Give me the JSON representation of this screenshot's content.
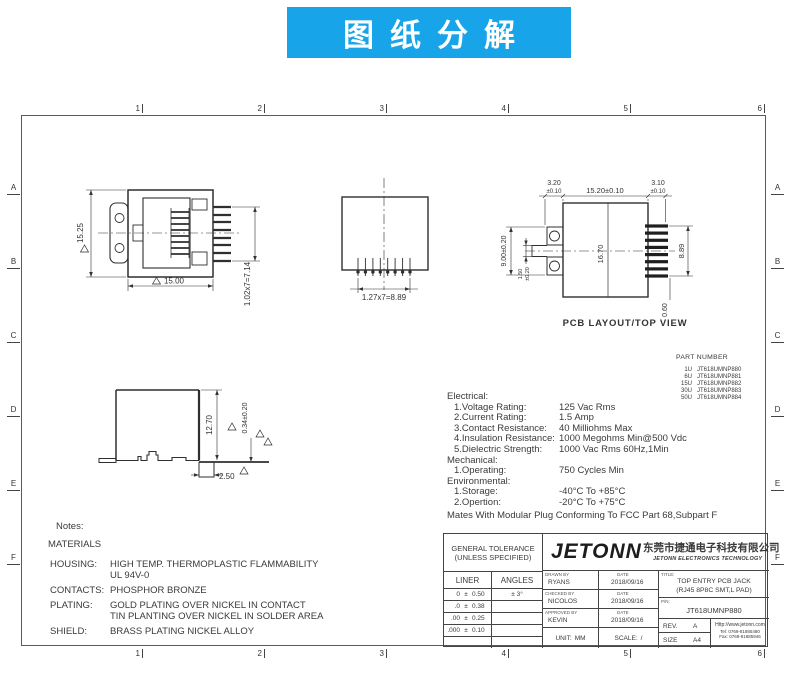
{
  "banner": {
    "title": "图纸分解",
    "bg_color": "#18a4e8"
  },
  "sheet": {
    "zone_cols": [
      "1",
      "2",
      "3",
      "4",
      "5",
      "6"
    ],
    "zone_rows": [
      "A",
      "B",
      "C",
      "D",
      "E",
      "F"
    ]
  },
  "views": {
    "front": {
      "dim_height": "15.25",
      "dim_width": "15.00",
      "dim_pin_span": "1.02x7=7.14"
    },
    "bottom": {
      "dim_pin_span": "1.27x7=8.89"
    },
    "pcb": {
      "caption": "PCB LAYOUT/TOP VIEW",
      "dim_tab": "3.20",
      "dim_tab_tol": "±0.10",
      "dim_body": "15.20±0.10",
      "dim_pin": "3.10",
      "dim_pin_tol": "±0.10",
      "dim_tab_pitch": "9.00±0.20",
      "dim_slot": "1.50",
      "dim_slot_tol": "±0.20",
      "dim_body_h": "16.70",
      "dim_pin_span": "8.89",
      "dim_pin_w": "0.60"
    },
    "side": {
      "dim_height": "12.70",
      "dim_pad": "0.34±0.20",
      "dim_foot": "2.50"
    }
  },
  "part_number": {
    "title": "PART NUMBER",
    "rows": [
      {
        "u": "1U",
        "pn": "JT618UMNP880"
      },
      {
        "u": "6U",
        "pn": "JT618UMNP881"
      },
      {
        "u": "15U",
        "pn": "JT618UMNP882"
      },
      {
        "u": "30U",
        "pn": "JT618UMNP883"
      },
      {
        "u": "50U",
        "pn": "JT618UMNP884"
      }
    ]
  },
  "specs": {
    "sections": [
      {
        "heading": "Electrical:",
        "items": [
          [
            "1.Voltage Rating:",
            "125 Vac Rms"
          ],
          [
            "2.Current Rating:",
            "1.5 Amp"
          ],
          [
            "3.Contact Resistance:",
            "40 Milliohms Max"
          ],
          [
            "4.Insulation Resistance:",
            "1000 Megohms Min@500 Vdc"
          ],
          [
            "5.Dielectric Strength:",
            "1000 Vac Rms 60Hz,1Min"
          ]
        ]
      },
      {
        "heading": "Mechanical:",
        "items": [
          [
            "1.Operating:",
            "750 Cycles Min"
          ]
        ]
      },
      {
        "heading": "Environmental:",
        "items": [
          [
            "1.Storage:",
            "-40°C To +85°C"
          ],
          [
            "2.Opertion:",
            "-20°C To +75°C"
          ]
        ]
      }
    ],
    "footer": "Mates With Modular Plug Conforming To FCC Part 68,Subpart F"
  },
  "notes": {
    "title": "Notes:",
    "materials_title": "MATERIALS",
    "rows": [
      {
        "label": "HOUSING:",
        "line1": "HIGH TEMP. THERMOPLASTIC FLAMMABILITY",
        "line2": "UL 94V-0"
      },
      {
        "label": "CONTACTS:",
        "line1": "PHOSPHOR BRONZE",
        "line2": ""
      },
      {
        "label": "PLATING:",
        "line1": "GOLD PLATING OVER NICKEL IN CONTACT",
        "line2": "TIN PLANTING OVER NICKEL IN SOLDER AREA"
      },
      {
        "label": "SHIELD:",
        "line1": "BRASS PLATING NICKEL ALLOY",
        "line2": ""
      }
    ]
  },
  "title_block": {
    "tolerance_header1": "GENERAL TOLERANCE",
    "tolerance_header2": "(UNLESS SPECIFIED)",
    "liner_label": "LINER",
    "angles_label": "ANGLES",
    "angles_val": "± 3°",
    "tol_rows": [
      {
        "range": "0",
        "pm": "±",
        "val": "0.50"
      },
      {
        "range": ".0",
        "pm": "±",
        "val": "0.38"
      },
      {
        "range": ".00",
        "pm": "±",
        "val": "0.25"
      },
      {
        "range": ".000",
        "pm": "±",
        "val": "0.10"
      }
    ],
    "logo": "JETONN",
    "company_cn": "东莞市捷通电子科技有限公司",
    "company_en": "JETONN ELECTRONICS TECHNOLOGY",
    "sign_rows": [
      {
        "label": "DRAWN BY",
        "name": "RYANS",
        "date_label": "DATE",
        "date": "2018/09/16"
      },
      {
        "label": "CHECKED BY",
        "name": "NICOLOS",
        "date_label": "DATE",
        "date": "2018/09/16"
      },
      {
        "label": "APPROVED BY",
        "name": "KEVIN",
        "date_label": "DATE",
        "date": "2018/09/16"
      }
    ],
    "unit_label": "UNIT:",
    "unit": "MM",
    "scale_label": "SCALE:",
    "scale": "/",
    "title_label": "TITLE:",
    "title1": "TOP ENTRY PCB JACK",
    "title2": "(RJ45 8P8C SMT,L PAD)",
    "pn_label": "P/N:",
    "pn": "JT618UMNP880",
    "rev_label": "REV.",
    "rev": "A",
    "size_label": "SIZE",
    "size": "A4",
    "website": "Http://www.jetonn.com",
    "tel": "Tel: 0769-81885480",
    "fax": "Fax: 0769-81885946"
  }
}
